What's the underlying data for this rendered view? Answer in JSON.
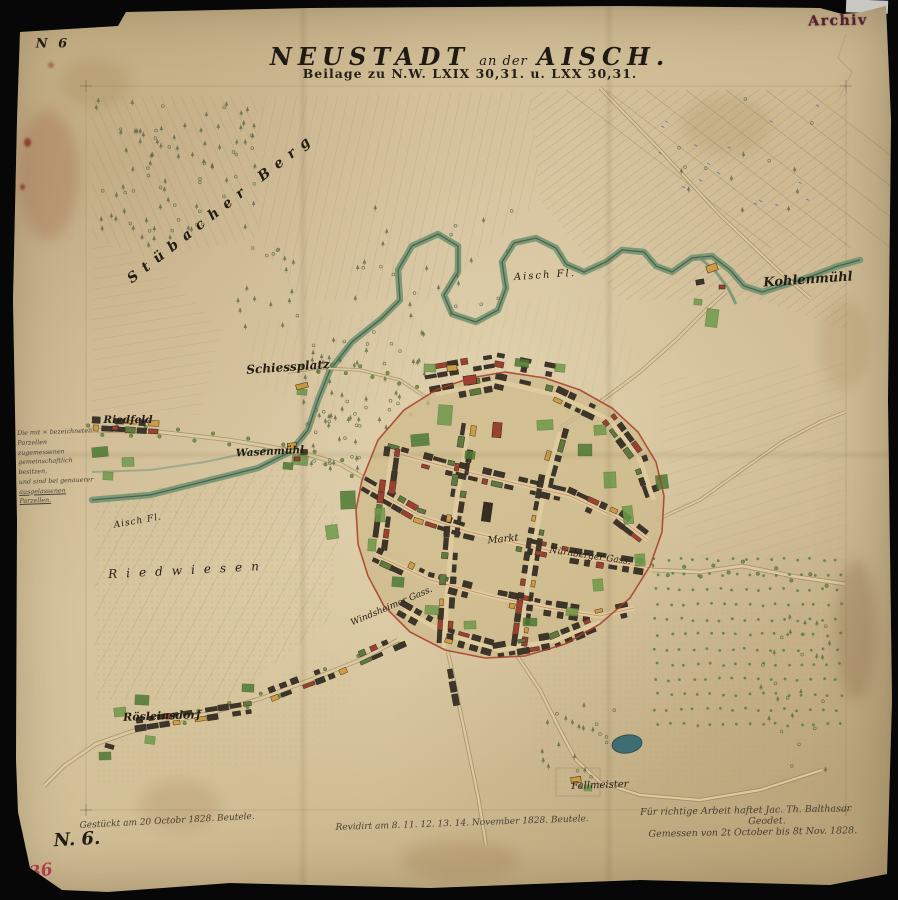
{
  "colors": {
    "paper": "#d5c39b",
    "ink": "#221c14",
    "sepia_line": "#8b7a5c",
    "boundary_red": "#a83c28",
    "river_green": "#3c5c46",
    "river_fill": "#6f9070",
    "garden_green": "#6f9a4b",
    "garden_dark": "#4d7a33",
    "building_dark": "#3e352a",
    "building_red": "#9c4030",
    "building_yellow": "#cf9c42",
    "pond_teal": "#3f6d74",
    "stamp_maroon": "#54202f",
    "red_note": "#b03345",
    "handwriting": "#474033"
  },
  "corner_marks": {
    "sheet_number_top": "N 6",
    "sheet_number_bottom": "N. 6.",
    "inventory_red": "36",
    "archive_stamp": "Archiv"
  },
  "title": {
    "line1_a": "NEUSTADT",
    "line1_b": "an der",
    "line1_c": "AISCH.",
    "line2": "Beilage zu N.W. LXIX 30,31. u. LXX 30,31."
  },
  "map_labels": {
    "stuebacher_berg": "Stübacher Berg",
    "aisch_upper": "Aisch Fl.",
    "aisch_lower": "Aisch Fl.",
    "kohlenmuehl": "Kohlenmühl",
    "schiessplatz": "Schiessplatz",
    "riedfeld": "Riedfeld",
    "wasenmuehl": "Wasenmühl",
    "riedwiesen": "Riedwiesen",
    "markt": "Markt",
    "nuernberger_gasse": "Nürnberger Gass.",
    "windsheimer_gasse": "Windsheimer Gass.",
    "roesleinsdorf": "Rösleinsdorf",
    "fallmeister": "Fallmeister"
  },
  "margin_note": {
    "line1": "Die mit × bezeichneten",
    "line2": "Parzellen zugemessenen",
    "line3": "gemeinschaftlich besitzen,",
    "line4": "und sind bei genauerer",
    "line5": "ausgelassenen Parzellen."
  },
  "footer_notes": {
    "created": "Gestückt am 20 Octobr 1828. Beutele.",
    "revised": "Revidirt am 8. 11. 12. 13. 14. November 1828. Beutele.",
    "liability_1": "Für richtige Arbeit haftet Jac. Th. Balthasar",
    "liability_2": "Geodet.",
    "measured": "Gemessen von 2t October bis 8t Nov. 1828."
  }
}
